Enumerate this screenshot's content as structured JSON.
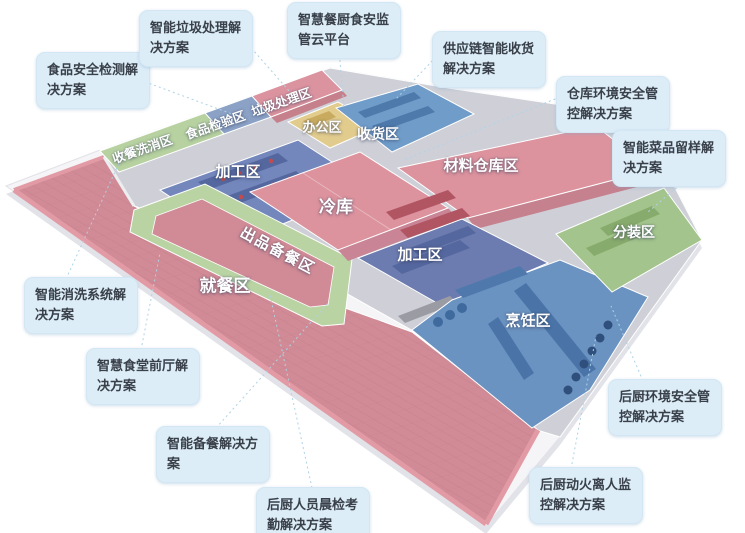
{
  "diagram": {
    "title_hint": "smart-canteen-isometric-floor-plan",
    "zones": [
      {
        "id": "shoucan-xixiao",
        "label": "收餐洗消区",
        "color": "#b7d2a0"
      },
      {
        "id": "shipin-jianyan",
        "label": "食品检验区",
        "color": "#8ba2c6"
      },
      {
        "id": "laji-chuli",
        "label": "垃圾处理区",
        "color": "#db939f"
      },
      {
        "id": "bangong",
        "label": "办公区",
        "color": "#e2cc8d"
      },
      {
        "id": "shouhuo",
        "label": "收货区",
        "color": "#6f9cc9"
      },
      {
        "id": "cailiao-cangku",
        "label": "材料仓库区",
        "color": "#dc939e"
      },
      {
        "id": "jiagong-1",
        "label": "加工区",
        "color": "#7387bc"
      },
      {
        "id": "lengku",
        "label": "冷库",
        "color": "#dc939e"
      },
      {
        "id": "jiagong-2",
        "label": "加工区",
        "color": "#6c7cb0"
      },
      {
        "id": "fenzhuang",
        "label": "分装区",
        "color": "#a3c48c"
      },
      {
        "id": "pengren",
        "label": "烹饪区",
        "color": "#6b93c1"
      },
      {
        "id": "jiucan",
        "label": "就餐区",
        "color": "#d18b96"
      },
      {
        "id": "chupin-beican",
        "label": "出品备餐区",
        "color": "#b9d3a3"
      }
    ],
    "callouts": [
      {
        "id": "food-safety-testing",
        "text": "食品安全检测解决方案"
      },
      {
        "id": "smart-garbage",
        "text": "智能垃圾处理解决方案"
      },
      {
        "id": "food-safety-cloud",
        "text": "智慧餐厨食安监管云平台"
      },
      {
        "id": "supply-chain-receiving",
        "text": "供应链智能收货解决方案"
      },
      {
        "id": "warehouse-env-safety",
        "text": "仓库环境安全管控解决方案"
      },
      {
        "id": "dish-sample-retention",
        "text": "智能菜品留样解决方案"
      },
      {
        "id": "smart-washing",
        "text": "智能消洗系统解决方案"
      },
      {
        "id": "front-hall",
        "text": "智慧食堂前厅解决方案"
      },
      {
        "id": "smart-meal-prep",
        "text": "智能备餐解决方案"
      },
      {
        "id": "morning-check",
        "text": "后厨人员晨检考勤解决方案"
      },
      {
        "id": "kitchen-env-safety",
        "text": "后厨环境安全管控解决方案"
      },
      {
        "id": "fire-leave-monitor",
        "text": "后厨动火离人监控解决方案"
      }
    ],
    "style": {
      "callout_bg": "#dcedf8",
      "callout_text": "#39404a",
      "leader_color": "#aed3e6",
      "slab_color": "#f5f5f8",
      "background": "#ffffff"
    }
  }
}
